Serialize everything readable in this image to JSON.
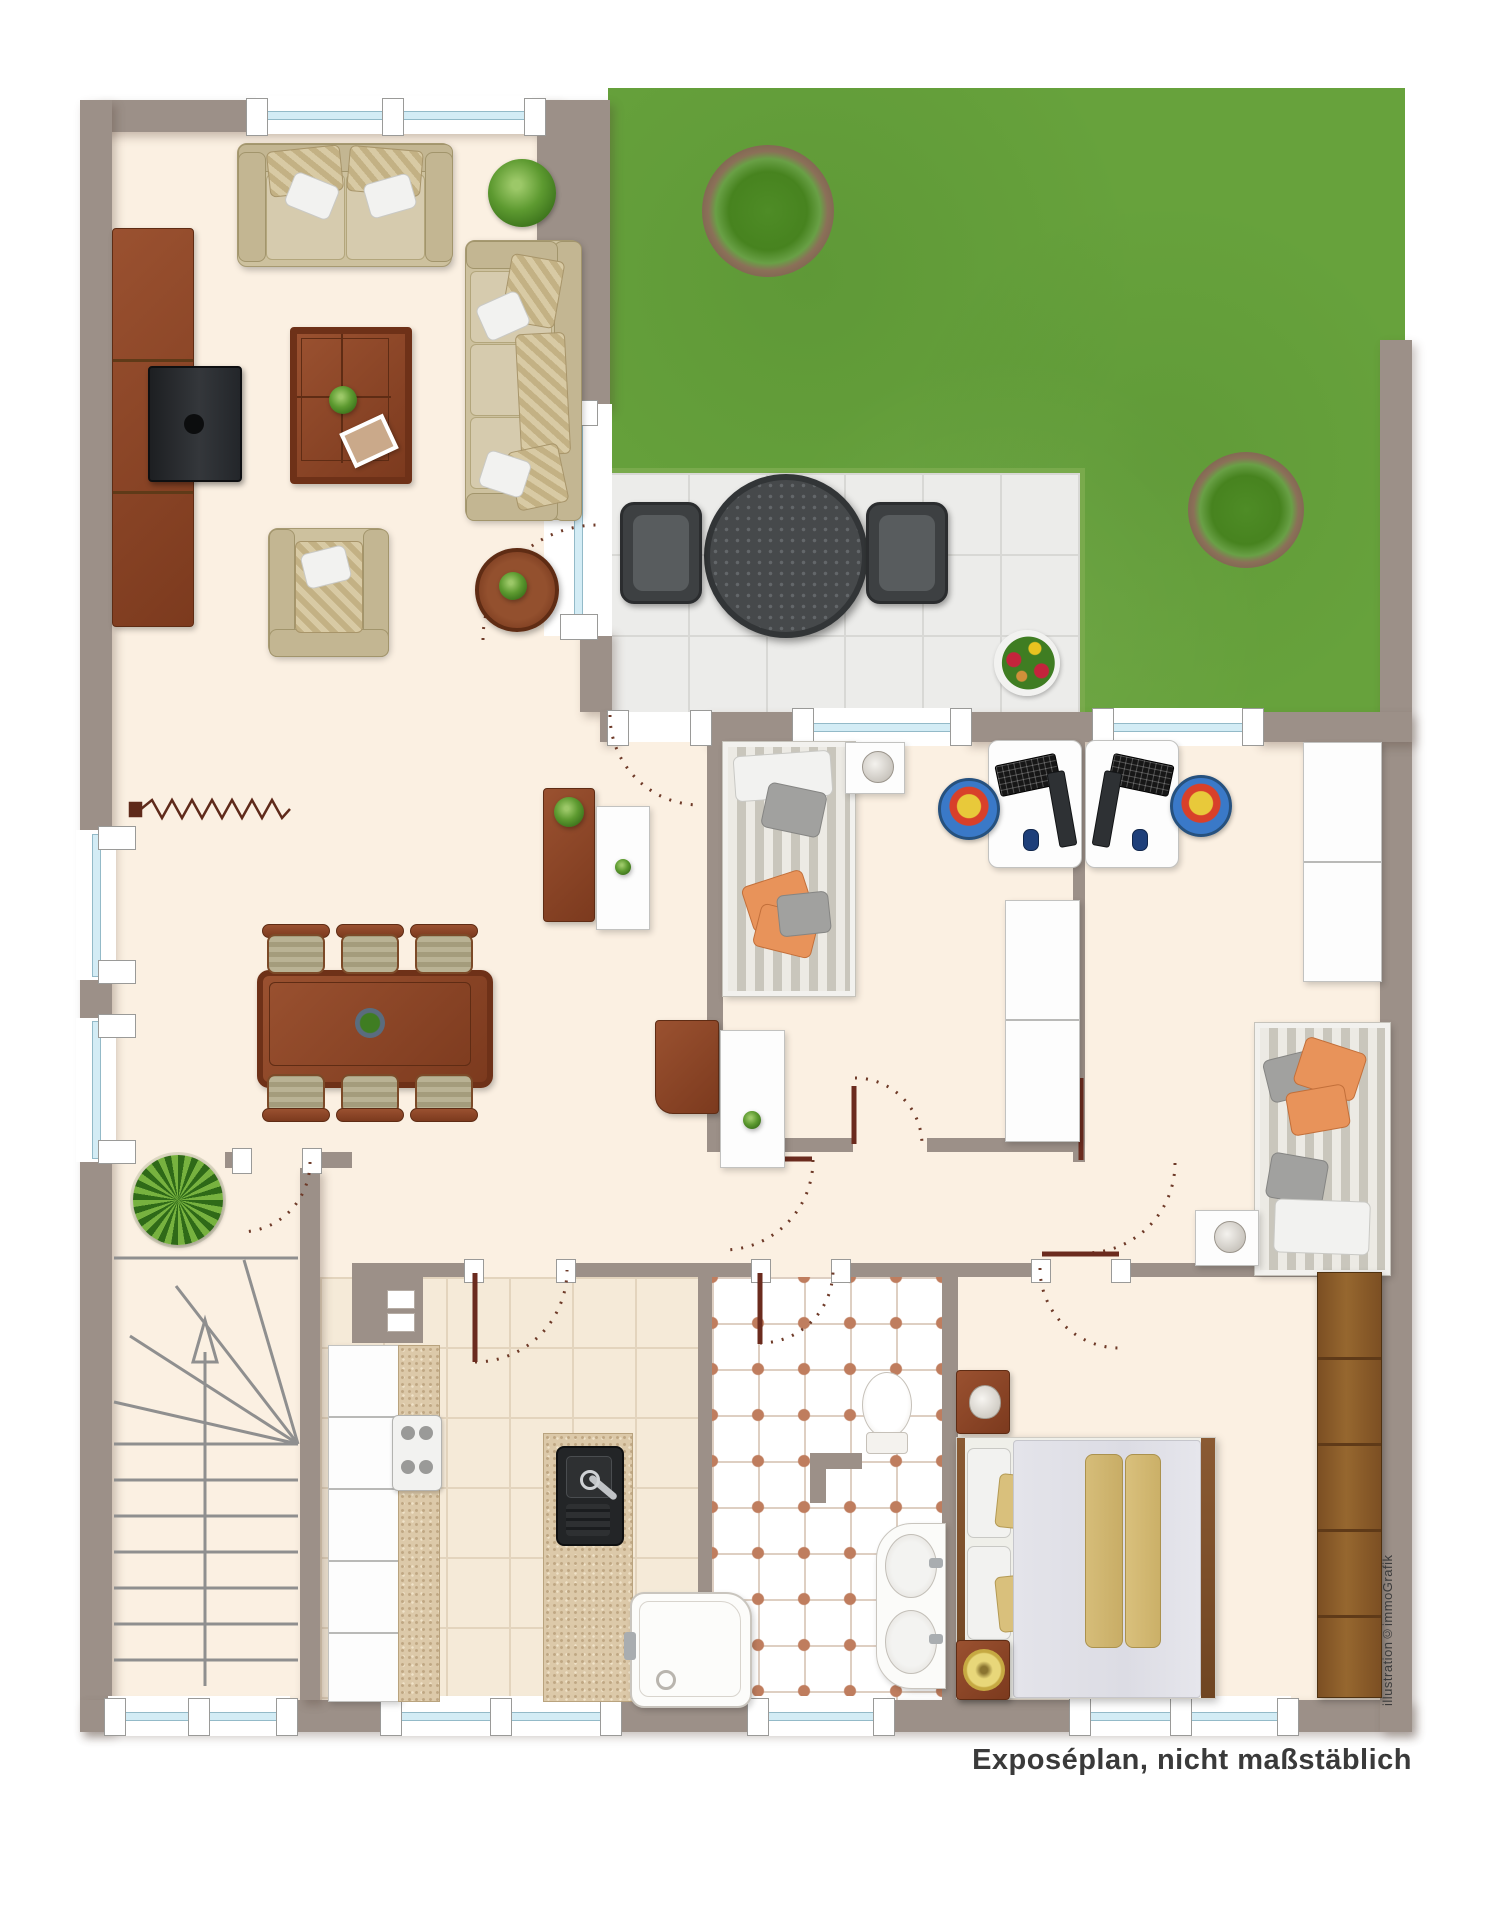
{
  "caption": {
    "text": "Exposéplan, nicht maßstäblich"
  },
  "watermark": {
    "text": "illustration©immoGrafik"
  },
  "palette": {
    "wall": "#9c9088",
    "floor": "#fbf0e2",
    "grass": "#67a23c",
    "terrace_tile": "#ececea",
    "bath_tile_dot": "#bf7d5e",
    "kitchen_floor": "#f5ead8",
    "wood_dark": "#8a4126",
    "wardrobe_wood": "#7e5228",
    "sofa_beige": "#cdc19e",
    "accent_orange": "#e8935a",
    "accent_yellow": "#d9c07c",
    "door_swing": "#6e3a28",
    "glazing": "#d3ecf5"
  },
  "plan": {
    "type": "floor-plan",
    "rooms": [
      {
        "name": "living-room",
        "furniture": [
          "two-seat-sofa",
          "three-seat-sofa",
          "armchair",
          "coffee-table",
          "tv-sideboard",
          "round-side-table",
          "houseplant"
        ]
      },
      {
        "name": "dining-area",
        "furniture": [
          "dining-table",
          "six-dining-chairs",
          "radiator-zigzag",
          "yucca-plant",
          "sideboard",
          "tall-cabinet"
        ]
      },
      {
        "name": "garden",
        "furniture": [
          "lawn",
          "round-bush",
          "round-bush",
          "terrace",
          "patio-table",
          "two-patio-chairs",
          "flower-pot"
        ]
      },
      {
        "name": "child-room-1",
        "furniture": [
          "single-bed",
          "nightstand-with-lamp",
          "computer-desk",
          "kids-chair",
          "white-wardrobe"
        ]
      },
      {
        "name": "child-room-2",
        "furniture": [
          "computer-desk",
          "kids-chair",
          "white-wardrobe",
          "single-bed",
          "nightstand-with-lamp"
        ]
      },
      {
        "name": "hallway",
        "furniture": [
          "sideboard",
          "tall-cabinet"
        ]
      },
      {
        "name": "kitchen",
        "furniture": [
          "cabinet-run",
          "stove",
          "sink-counter",
          "vent-shaft"
        ]
      },
      {
        "name": "bathroom",
        "furniture": [
          "toilet",
          "double-washbasin",
          "shower-tub"
        ]
      },
      {
        "name": "bedroom",
        "furniture": [
          "double-bed",
          "nightstand-with-lamp",
          "nightstand-with-dish",
          "wooden-wardrobe"
        ]
      },
      {
        "name": "staircase",
        "furniture": [
          "winder-stairs",
          "direction-arrow"
        ]
      }
    ]
  }
}
